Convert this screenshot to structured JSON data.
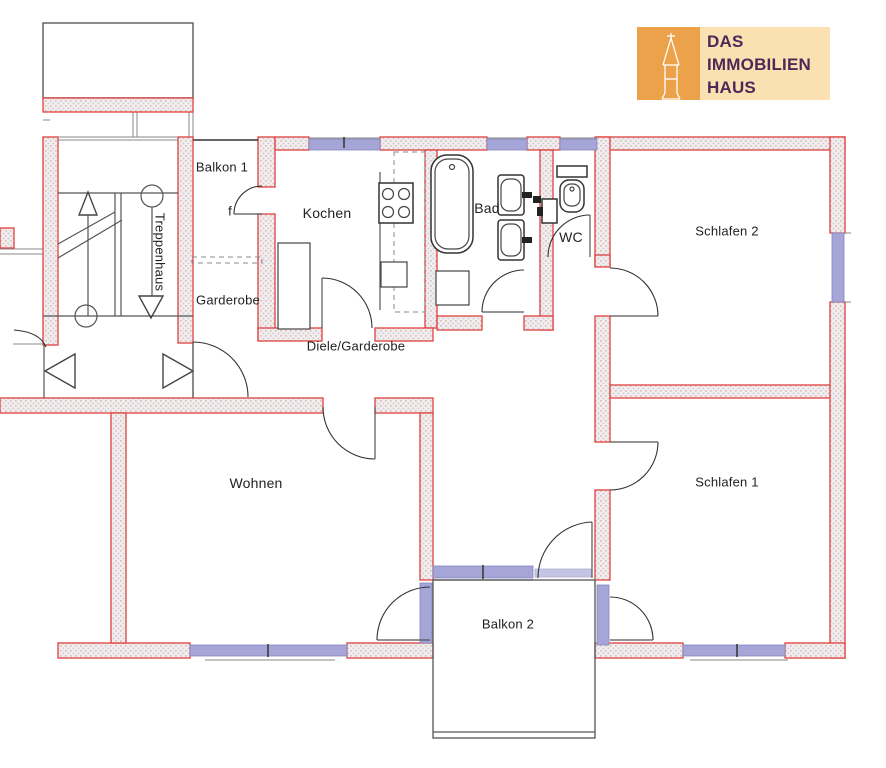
{
  "colors": {
    "wall-stroke": "#e04040",
    "window-fill": "#a5a5d8",
    "window-stroke": "#8585bb",
    "line": "#555555",
    "line-dark": "#333333",
    "label": "#222222",
    "logo-orange": "#eca14b",
    "logo-peach": "#fbe0b2",
    "logo-text": "#4e2856"
  },
  "labels": {
    "balkon1": "Balkon 1",
    "treppenhaus": "Treppenhaus",
    "kochen": "Kochen",
    "diele": "Diele/Garderobe",
    "garderobe": "Garderobe",
    "bad": "Bad",
    "wc": "WC",
    "schlafen2": "Schlafen 2",
    "schlafen1": "Schlafen 1",
    "wohnen": "Wohnen",
    "balkon2": "Balkon 2",
    "door_f": "f"
  },
  "logo": {
    "line1": "DAS",
    "line2": "IMMOBILIEN",
    "line3": "HAUS",
    "icon": "church-tower-icon"
  }
}
